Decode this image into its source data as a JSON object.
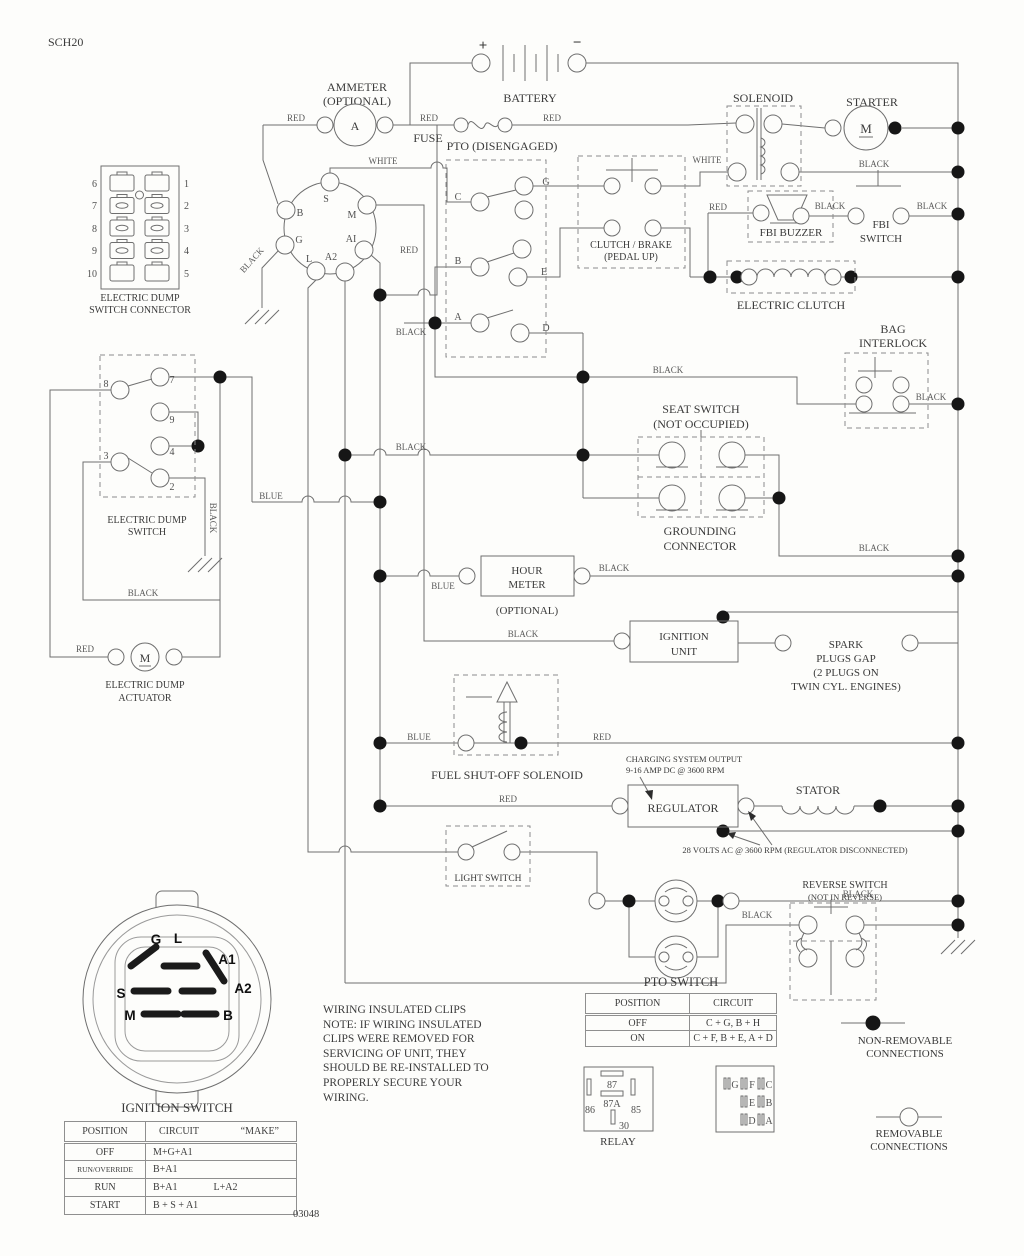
{
  "colors": {
    "line": "#6f6f6f",
    "text": "#3c3c3c",
    "junction": "#161616"
  },
  "L": {
    "sch": "SCH20",
    "ammeter1": "AMMETER",
    "ammeter2": "(OPTIONAL)",
    "ammeter_a": "A",
    "battery": "BATTERY",
    "plus": "+",
    "minus": "−",
    "fuse": "FUSE",
    "pto_head": "PTO (DISENGAGED)",
    "solenoid": "SOLENOID",
    "starter": "STARTER",
    "starter_m": "M",
    "fbi_buzzer": "FBI BUZZER",
    "fbi_sw1": "FBI",
    "fbi_sw2": "SWITCH",
    "eclutch": "ELECTRIC CLUTCH",
    "bag1": "BAG",
    "bag2": "INTERLOCK",
    "clutch1": "CLUTCH / BRAKE",
    "clutch2": "(PEDAL UP)",
    "conn1": "ELECTRIC DUMP",
    "conn2": "SWITCH CONNECTOR",
    "dump1": "ELECTRIC DUMP",
    "dump2": "SWITCH",
    "act1": "ELECTRIC DUMP",
    "act2": "ACTUATOR",
    "act_m": "M",
    "seat1": "SEAT SWITCH",
    "seat2": "(NOT OCCUPIED)",
    "ground1": "GROUNDING",
    "ground2": "CONNECTOR",
    "hour1": "HOUR",
    "hour2": "METER",
    "hour3": "(OPTIONAL)",
    "ign1": "IGNITION",
    "ign2": "UNIT",
    "spark1": "SPARK",
    "spark2": "PLUGS GAP",
    "spark3": "(2 PLUGS ON",
    "spark4": "TWIN CYL. ENGINES)",
    "fuel": "FUEL SHUT-OFF SOLENOID",
    "chg1": "CHARGING SYSTEM OUTPUT",
    "chg2": "9-16 AMP DC @ 3600 RPM",
    "regulator": "REGULATOR",
    "stator": "STATOR",
    "volts": "28 VOLTS AC @ 3600 RPM (REGULATOR DISCONNECTED)",
    "light": "LIGHT SWITCH",
    "headlights": "HEADLIGHTS",
    "rev1": "REVERSE SWITCH",
    "rev2": "(NOT IN REVERSE)",
    "nonrem1": "NON-REMOVABLE",
    "nonrem2": "CONNECTIONS",
    "rem1": "REMOVABLE",
    "rem2": "CONNECTIONS",
    "relay": "RELAY",
    "ignsw": "IGNITION SWITCH"
  },
  "wires": [
    "RED",
    "RED",
    "RED",
    "WHITE",
    "WHITE",
    "BLACK",
    "RED",
    "BLACK",
    "BLACK",
    "RED",
    "BLACK",
    "BLACK",
    "BLACK",
    "BLACK",
    "BLACK",
    "BLUE",
    "BLACK",
    "BLACK",
    "BLACK",
    "BLUE",
    "BLACK",
    "BLACK",
    "BLUE",
    "RED",
    "RED",
    "BLACK",
    "BLACK",
    "RED"
  ],
  "pins": {
    "dump_conn_l": [
      "6",
      "7",
      "8",
      "9",
      "10"
    ],
    "dump_conn_r": [
      "1",
      "2",
      "3",
      "4",
      "5"
    ],
    "dump_sw": [
      "8",
      "7",
      "9",
      "4",
      "3",
      "2"
    ],
    "pto": [
      "C",
      "G",
      "B",
      "E",
      "A",
      "D"
    ],
    "ign_conn": [
      "S",
      "B",
      "M",
      "G",
      "AI",
      "L",
      "A2"
    ],
    "rotary": [
      "G",
      "L",
      "A1",
      "A2",
      "S",
      "M",
      "B"
    ],
    "relay": [
      "87",
      "87A",
      "86",
      "85",
      "30"
    ],
    "grid": [
      "G",
      "F",
      "C",
      "E",
      "B",
      "D",
      "A"
    ]
  },
  "tables": {
    "pto": {
      "title": "PTO SWITCH",
      "h": [
        "POSITION",
        "CIRCUIT"
      ],
      "rows": [
        [
          "OFF",
          "C + G, B + H"
        ],
        [
          "ON",
          "C + F, B + E, A + D"
        ]
      ]
    },
    "ignition": {
      "h": [
        "POSITION",
        "CIRCUIT",
        "“MAKE”"
      ],
      "rows": [
        [
          "OFF",
          "M+G+A1",
          ""
        ],
        [
          "RUN/OVERRIDE",
          "B+A1",
          ""
        ],
        [
          "RUN",
          "B+A1",
          "L+A2"
        ],
        [
          "START",
          "B + S + A1",
          ""
        ]
      ]
    }
  },
  "note": [
    "WIRING INSULATED CLIPS",
    "NOTE:  IF WIRING INSULATED",
    "CLIPS WERE REMOVED FOR",
    "SERVICING OF UNIT, THEY",
    "SHOULD BE RE-INSTALLED TO",
    "PROPERLY SECURE YOUR",
    "WIRING."
  ],
  "code": "03048"
}
